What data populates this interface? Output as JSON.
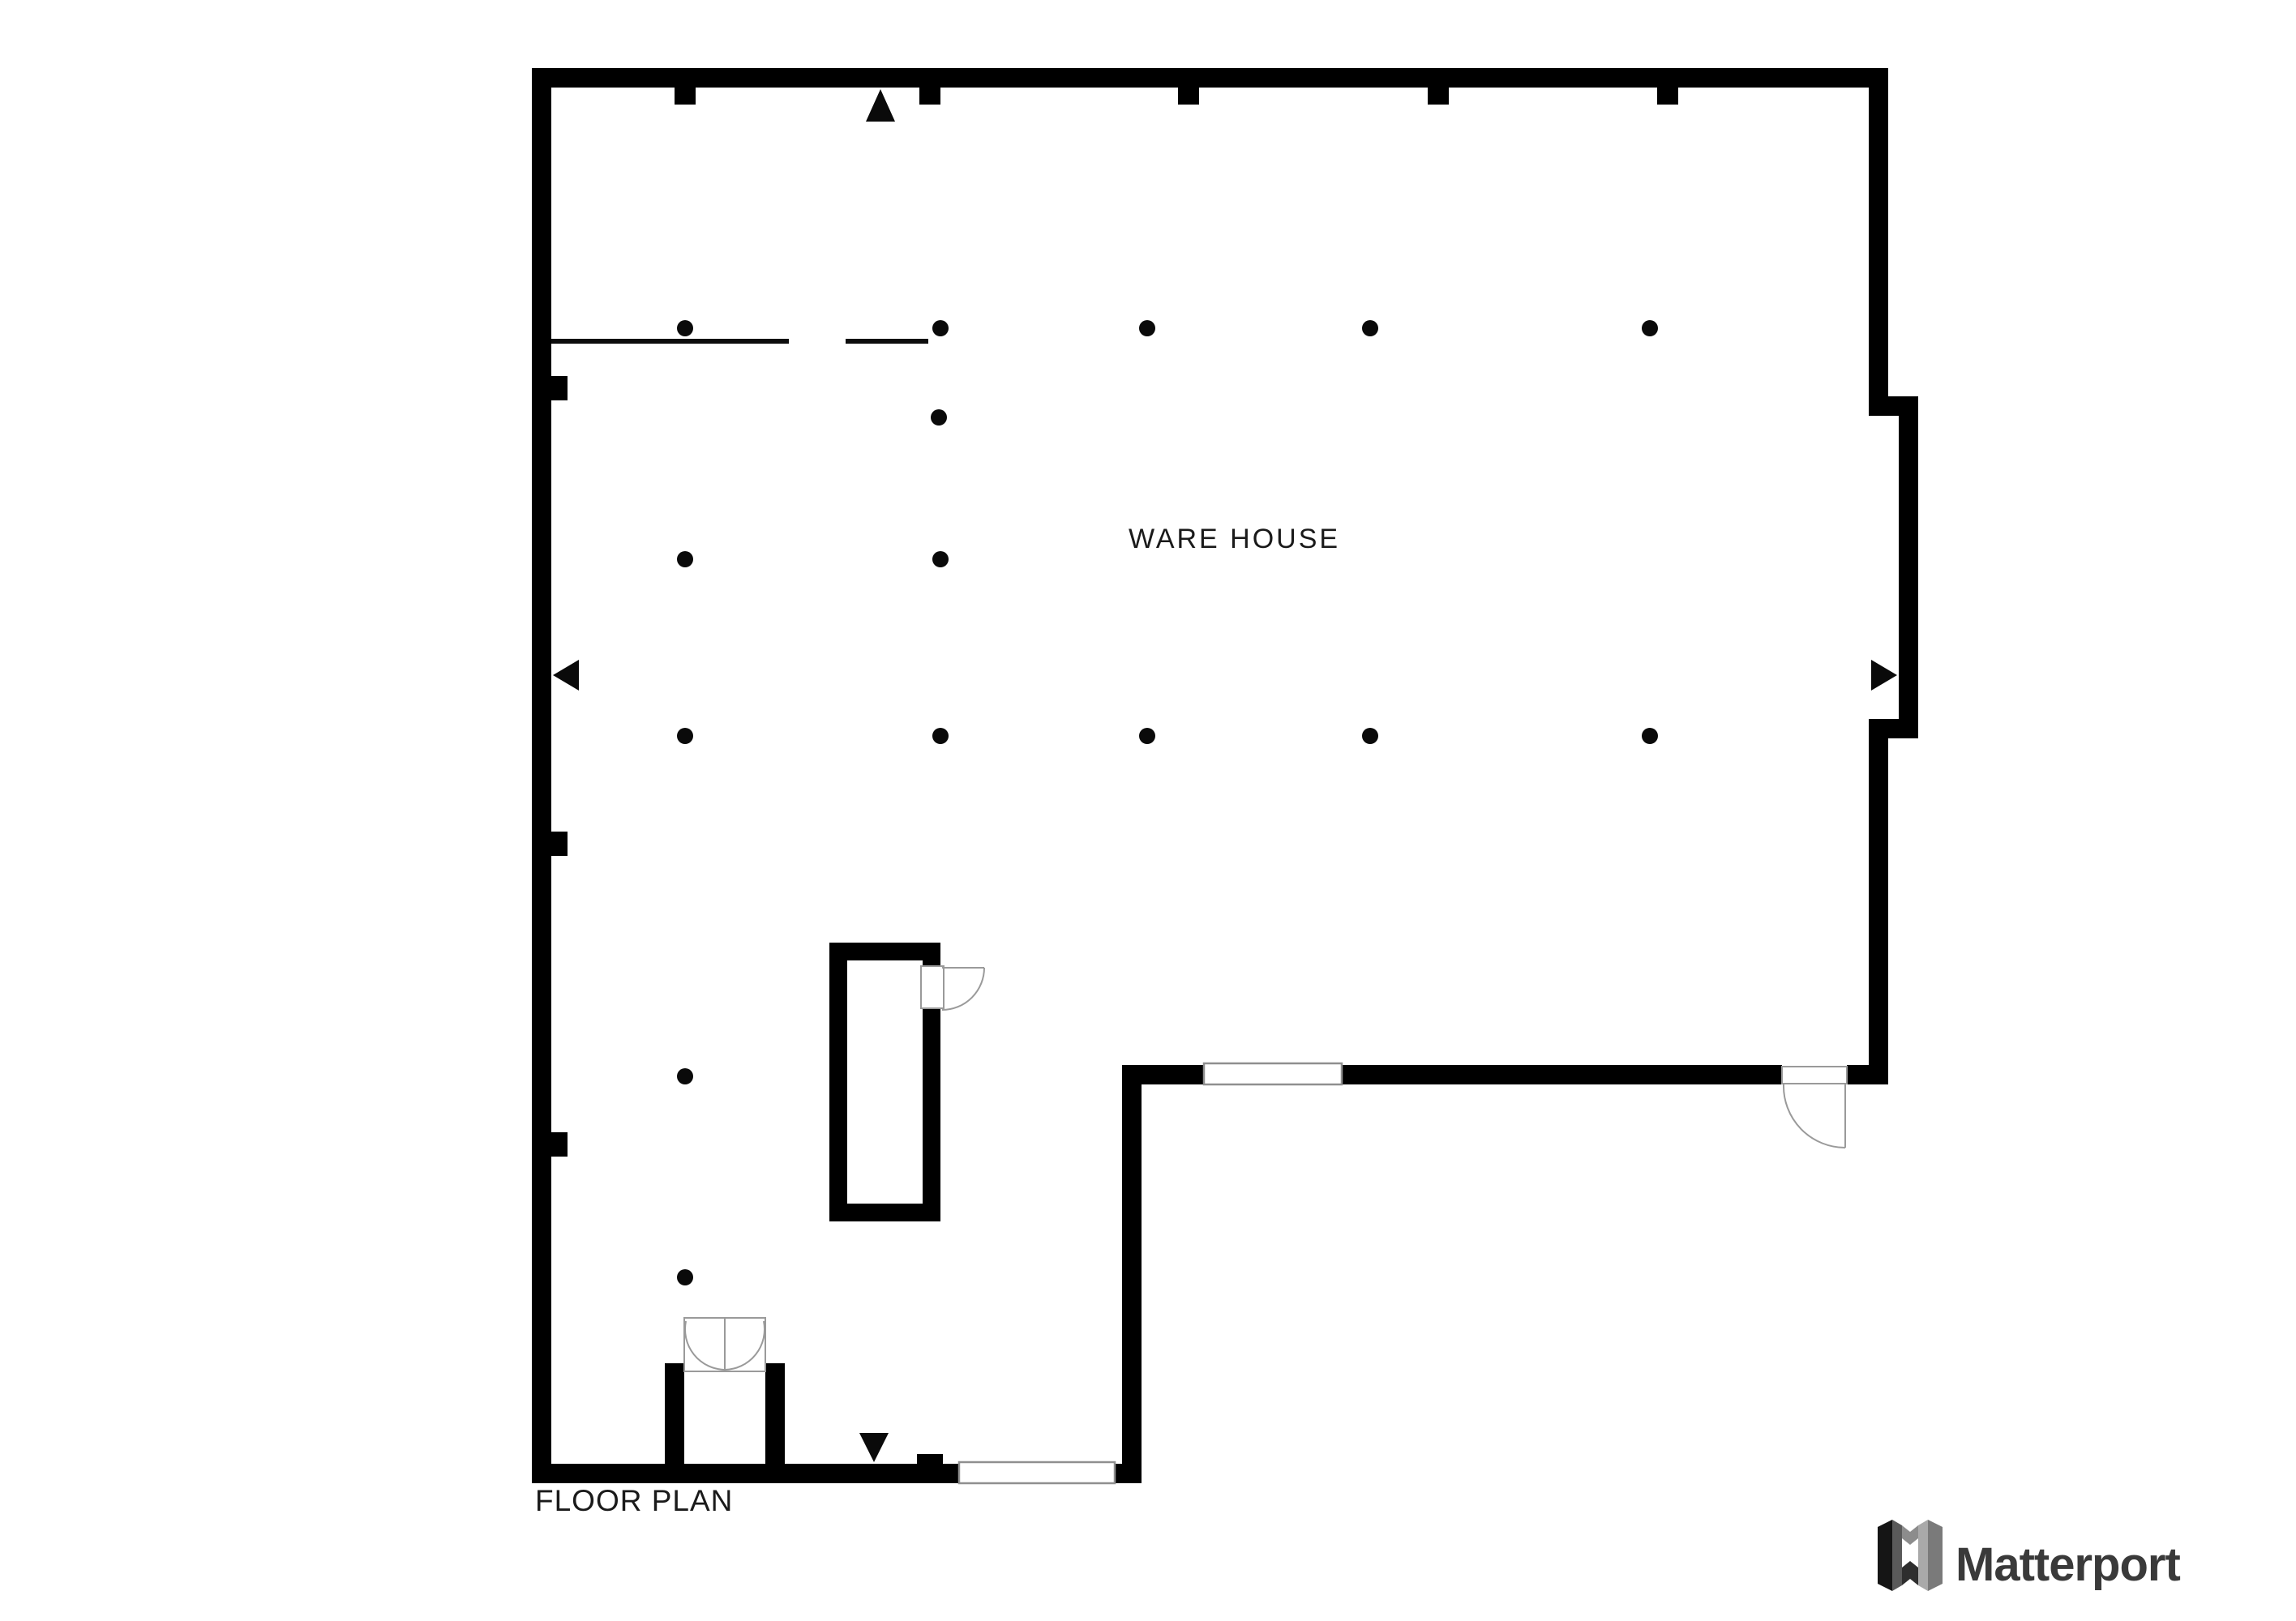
{
  "page": {
    "background_color": "#ffffff"
  },
  "floor_plan": {
    "room_label": "WARE HOUSE",
    "plan_title": "FLOOR PLAN",
    "wall_color": "#000000",
    "door_window_outline_color": "#9a9a9a",
    "label_color": "#1a1a1a",
    "column_dots": {
      "color": "#0a0a0a",
      "radius": 10,
      "points": [
        [
          845,
          405
        ],
        [
          1160,
          405
        ],
        [
          1415,
          405
        ],
        [
          1690,
          405
        ],
        [
          2035,
          405
        ],
        [
          1158,
          515
        ],
        [
          845,
          690
        ],
        [
          1160,
          690
        ],
        [
          845,
          908
        ],
        [
          1160,
          908
        ],
        [
          1415,
          908
        ],
        [
          1690,
          908
        ],
        [
          2035,
          908
        ],
        [
          845,
          1328
        ],
        [
          845,
          1576
        ]
      ]
    },
    "wall_stubs": {
      "color": "#000000",
      "top_x_centers": [
        845,
        1147,
        1466,
        1774,
        2057
      ],
      "left_y_centers": [
        479,
        1041,
        1412
      ],
      "bottom_x_centers": [
        1147
      ]
    }
  },
  "branding": {
    "logo_text": "Matterport",
    "logo_text_color": "#3a3a3a",
    "logo_icon": "matterport-m-icon"
  }
}
